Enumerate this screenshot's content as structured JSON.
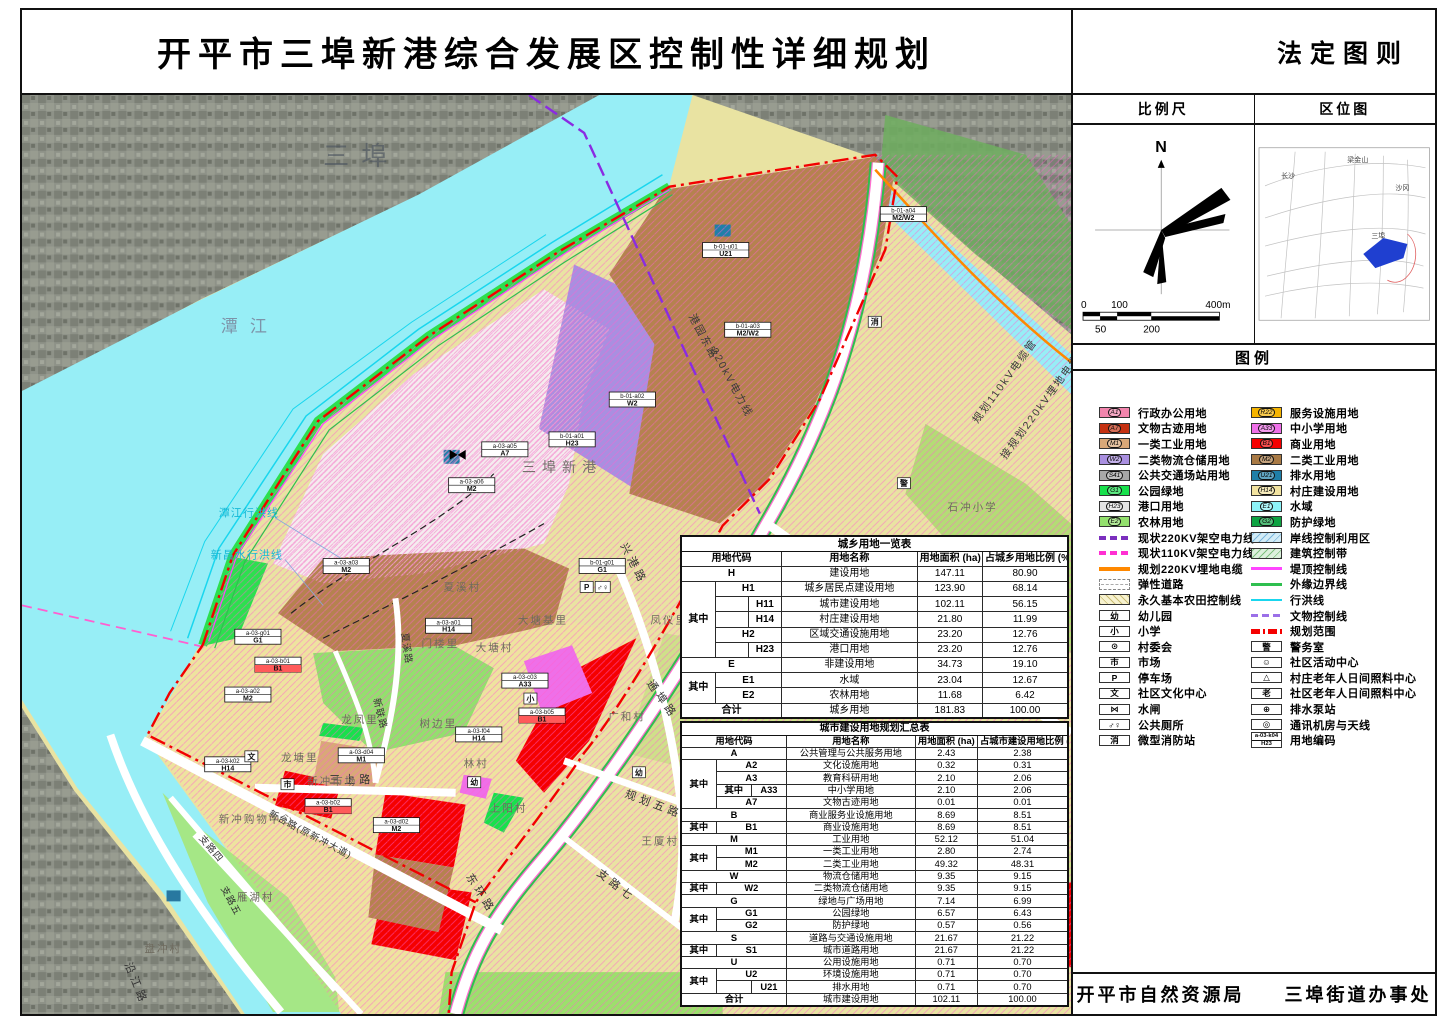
{
  "title": "开平市三埠新港综合发展区控制性详细规划",
  "panel": {
    "doc_type": "法定图则",
    "scale_header": "比例尺",
    "location_header": "区位图",
    "legend_header": "图例",
    "compass_n": "N",
    "scale_bar": {
      "t0": "0",
      "t50": "50",
      "t100": "100",
      "t200": "200",
      "t400": "400m"
    },
    "location_map": {
      "labels": [
        "梁金山",
        "长沙",
        "沙冈",
        "三埠"
      ],
      "site_color": "#1f3fd0"
    },
    "footer_left": "开平市自然资源局",
    "footer_right": "三埠街道办事处"
  },
  "legend": {
    "zones_left": [
      {
        "code": "A1",
        "label": "行政办公用地",
        "color": "#f285ad"
      },
      {
        "code": "A7",
        "label": "文物古迹用地",
        "color": "#c53010"
      },
      {
        "code": "M1",
        "label": "一类工业用地",
        "color": "#d9a878"
      },
      {
        "code": "W2",
        "label": "二类物流仓储用地",
        "color": "#a98fe0"
      },
      {
        "code": "S41",
        "label": "公共交通场站用地",
        "color": "#a8a8a8"
      },
      {
        "code": "G1",
        "label": "公园绿地",
        "color": "#17e14b"
      },
      {
        "code": "H23",
        "label": "港口用地",
        "color": "#e4e4e4"
      },
      {
        "code": "E2",
        "label": "农林用地",
        "color": "#93e06d"
      }
    ],
    "zones_right": [
      {
        "code": "R22",
        "label": "服务设施用地",
        "color": "#f5b400"
      },
      {
        "code": "A33",
        "label": "中小学用地",
        "color": "#ef6fe8"
      },
      {
        "code": "B1",
        "label": "商业用地",
        "color": "#f50000"
      },
      {
        "code": "M2",
        "label": "二类工业用地",
        "color": "#a97a45"
      },
      {
        "code": "U21",
        "label": "排水用地",
        "color": "#1f7fa8"
      },
      {
        "code": "H14",
        "label": "村庄建设用地",
        "color": "#f2e3a0"
      },
      {
        "code": "E1",
        "label": "水域",
        "color": "#8df3f8"
      },
      {
        "code": "G2",
        "label": "防护绿地",
        "color": "#0ea342"
      }
    ],
    "misc_left": [
      {
        "label": "现状220KV架空电力线",
        "color": "#7b2fbe"
      },
      {
        "label": "现状110KV架空电力线",
        "color": "#ff2fd2"
      },
      {
        "label": "规划220KV埋地电缆",
        "color": "#ff8800"
      },
      {
        "label": "弹性道路",
        "color": "#9a9a9a"
      },
      {
        "label": "永久基本农田控制线",
        "color": "#f7f2cf"
      },
      {
        "glyph": "幼",
        "label": "幼儿园"
      },
      {
        "glyph": "小",
        "label": "小学"
      },
      {
        "glyph": "⊙",
        "label": "村委会"
      },
      {
        "glyph": "市",
        "label": "市场"
      },
      {
        "glyph": "P",
        "label": "停车场"
      },
      {
        "glyph": "文",
        "label": "社区文化中心"
      },
      {
        "glyph": "⋈",
        "label": "水闸"
      },
      {
        "glyph": "♂♀",
        "label": "公共厕所"
      },
      {
        "glyph": "消",
        "label": "微型消防站"
      }
    ],
    "misc_right": [
      {
        "label": "岸线控制利用区",
        "color": "#d2ecf7"
      },
      {
        "label": "建筑控制带",
        "color": "#ddf0dd"
      },
      {
        "label": "堤顶控制线",
        "color": "#ff45ff"
      },
      {
        "label": "外缘边界线",
        "color": "#2fbf4f"
      },
      {
        "label": "行洪线",
        "color": "#19d6ee"
      },
      {
        "label": "文物控制线",
        "color": "#9b6fe8"
      },
      {
        "label": "规划范围",
        "color": "#f50000"
      },
      {
        "glyph": "警",
        "label": "警务室"
      },
      {
        "glyph": "☺",
        "label": "社区活动中心"
      },
      {
        "glyph": "△",
        "label": "村庄老年人日间照料中心"
      },
      {
        "glyph": "老",
        "label": "社区老年人日间照料中心"
      },
      {
        "glyph": "⊕",
        "label": "排水泵站"
      },
      {
        "glyph": "◎",
        "label": "通讯机房与天线"
      },
      {
        "line1": "a-03-k04",
        "line2": "H23",
        "label": "用地编码"
      }
    ]
  },
  "t1": {
    "title": "城乡用地一览表",
    "h0": "用地代码",
    "h1": "用地名称",
    "h2": "用地面积 (ha)",
    "h3": "占城乡用地比例 (%)",
    "rows": [
      {
        "c0": "H",
        "name": "建设用地",
        "a": "147.11",
        "p": "80.90"
      },
      {
        "qz": "其中",
        "code": "H1",
        "name": "城乡居民点建设用地",
        "a": "123.90",
        "p": "68.14"
      },
      {
        "code": "H11",
        "name": "城市建设用地",
        "a": "102.11",
        "p": "56.15"
      },
      {
        "code": "H14",
        "name": "村庄建设用地",
        "a": "21.80",
        "p": "11.99"
      },
      {
        "code": "H2",
        "name": "区域交通设施用地",
        "a": "23.20",
        "p": "12.76"
      },
      {
        "code": "H23",
        "name": "港口用地",
        "a": "23.20",
        "p": "12.76"
      },
      {
        "c0": "E",
        "name": "非建设用地",
        "a": "34.73",
        "p": "19.10"
      },
      {
        "qz": "其中",
        "code": "E1",
        "name": "水域",
        "a": "23.04",
        "p": "12.67"
      },
      {
        "code": "E2",
        "name": "农林用地",
        "a": "11.68",
        "p": "6.42"
      },
      {
        "c0": "合计",
        "name": "城乡用地",
        "a": "181.83",
        "p": "100.00"
      }
    ]
  },
  "t2": {
    "title": "城市建设用地规划汇总表",
    "h0": "用地代码",
    "h1": "用地名称",
    "h2": "用地面积 (ha)",
    "h3": "占城市建设用地比例 (%)",
    "rows": [
      {
        "c0": "A",
        "name": "公共管理与公共服务用地",
        "a": "2.43",
        "p": "2.38"
      },
      {
        "qz": "其中",
        "code": "A2",
        "name": "文化设施用地",
        "a": "0.32",
        "p": "0.31"
      },
      {
        "code": "A3",
        "name": "教育科研用地",
        "a": "2.10",
        "p": "2.06"
      },
      {
        "qz2": "其中",
        "code": "A33",
        "name": "中小学用地",
        "a": "2.10",
        "p": "2.06"
      },
      {
        "code": "A7",
        "name": "文物古迹用地",
        "a": "0.01",
        "p": "0.01"
      },
      {
        "c0": "B",
        "name": "商业服务业设施用地",
        "a": "8.69",
        "p": "8.51"
      },
      {
        "qz": "其中",
        "code": "B1",
        "name": "商业设施用地",
        "a": "8.69",
        "p": "8.51"
      },
      {
        "c0": "M",
        "name": "工业用地",
        "a": "52.12",
        "p": "51.04"
      },
      {
        "qz": "其中",
        "code": "M1",
        "name": "一类工业用地",
        "a": "2.80",
        "p": "2.74"
      },
      {
        "code": "M2",
        "name": "二类工业用地",
        "a": "49.32",
        "p": "48.31"
      },
      {
        "c0": "W",
        "name": "物流仓储用地",
        "a": "9.35",
        "p": "9.15"
      },
      {
        "qz": "其中",
        "code": "W2",
        "name": "二类物流仓储用地",
        "a": "9.35",
        "p": "9.15"
      },
      {
        "c0": "G",
        "name": "绿地与广场用地",
        "a": "7.14",
        "p": "6.99"
      },
      {
        "qz": "其中",
        "code": "G1",
        "name": "公园绿地",
        "a": "6.57",
        "p": "6.43"
      },
      {
        "code": "G2",
        "name": "防护绿地",
        "a": "0.57",
        "p": "0.56"
      },
      {
        "c0": "S",
        "name": "道路与交通设施用地",
        "a": "21.67",
        "p": "21.22"
      },
      {
        "qz": "其中",
        "code": "S1",
        "name": "城市道路用地",
        "a": "21.67",
        "p": "21.22"
      },
      {
        "c0": "U",
        "name": "公用设施用地",
        "a": "0.71",
        "p": "0.70"
      },
      {
        "qz": "其中",
        "code": "U2",
        "name": "环境设施用地",
        "a": "0.71",
        "p": "0.70"
      },
      {
        "code": "U21",
        "name": "排水用地",
        "a": "0.71",
        "p": "0.70"
      },
      {
        "c0": "合计",
        "name": "城市建设用地",
        "a": "102.11",
        "p": "100.00"
      }
    ]
  },
  "map": {
    "watermark": "三埠",
    "river": "潭江",
    "flood1": "潭江行洪线",
    "flood2": "新昌水行洪线",
    "port": "三埠新港",
    "pw1": "港园东路",
    "pw2": "220kV电力线",
    "cb1": "规划110kV电缆管",
    "cb2": "接规划220kV埋地电缆",
    "roads": {
      "xg": "兴港路",
      "tb": "通埠路",
      "gh5": "规划五路",
      "zl7": "支路七",
      "dh": "东环路",
      "xt": "新台路(原新冲大道)",
      "ss": "三上路",
      "yj": "沿江路",
      "zl4": "支路四",
      "zl5": "支路五",
      "xx": "夏溪路",
      "xl": "新联路"
    },
    "places": {
      "xxc": "夏溪村",
      "dtjl": "大塘基里",
      "mll": "门楼里",
      "dtc": "大塘村",
      "lfl": "龙凤里",
      "sbl": "树边里",
      "lc": "林村",
      "syc": "上阳村",
      "ghc": "广和村",
      "ltl": "龙塘里",
      "xcsc": "新冲市场",
      "xcgw": "新冲购物中心",
      "yhc": "雁湖村",
      "pcc": "盘冲村",
      "fyl": "凤仪里",
      "wxc": "王厦村",
      "scxx": "石冲小学"
    },
    "icons": {
      "parking": "P",
      "toilet": "♂♀",
      "fire": "消",
      "prim": "小",
      "kind": "幼",
      "market": "市",
      "culture": "文",
      "police": "警"
    },
    "parcels": [
      {
        "code": "b-01-a01",
        "zone": "H23"
      },
      {
        "code": "b-01-a02",
        "zone": "W2"
      },
      {
        "code": "b-01-a03",
        "zone": "M2/W2"
      },
      {
        "code": "b-01-a04",
        "zone": "M2/W2"
      },
      {
        "code": "b-01-u01",
        "zone": "U21"
      },
      {
        "code": "a-03-a05",
        "zone": "A7"
      },
      {
        "code": "a-03-a06",
        "zone": "M2"
      },
      {
        "code": "a-03-a03",
        "zone": "M2"
      },
      {
        "code": "a-03-g01",
        "zone": "G1"
      },
      {
        "code": "a-03-b01",
        "zone": "B1"
      },
      {
        "code": "a-03-a02",
        "zone": "M2"
      },
      {
        "code": "a-03-a01",
        "zone": "H14"
      },
      {
        "code": "a-03-c03",
        "zone": "A33"
      },
      {
        "code": "a-03-b05",
        "zone": "B1"
      },
      {
        "code": "a-03-f04",
        "zone": "H14"
      },
      {
        "code": "a-03-d04",
        "zone": "M1"
      },
      {
        "code": "a-03-d02",
        "zone": "M2"
      },
      {
        "code": "a-03-k02",
        "zone": "H14"
      },
      {
        "code": "a-03-b02",
        "zone": "B1"
      },
      {
        "code": "b-01-g01",
        "zone": "G1"
      }
    ]
  }
}
